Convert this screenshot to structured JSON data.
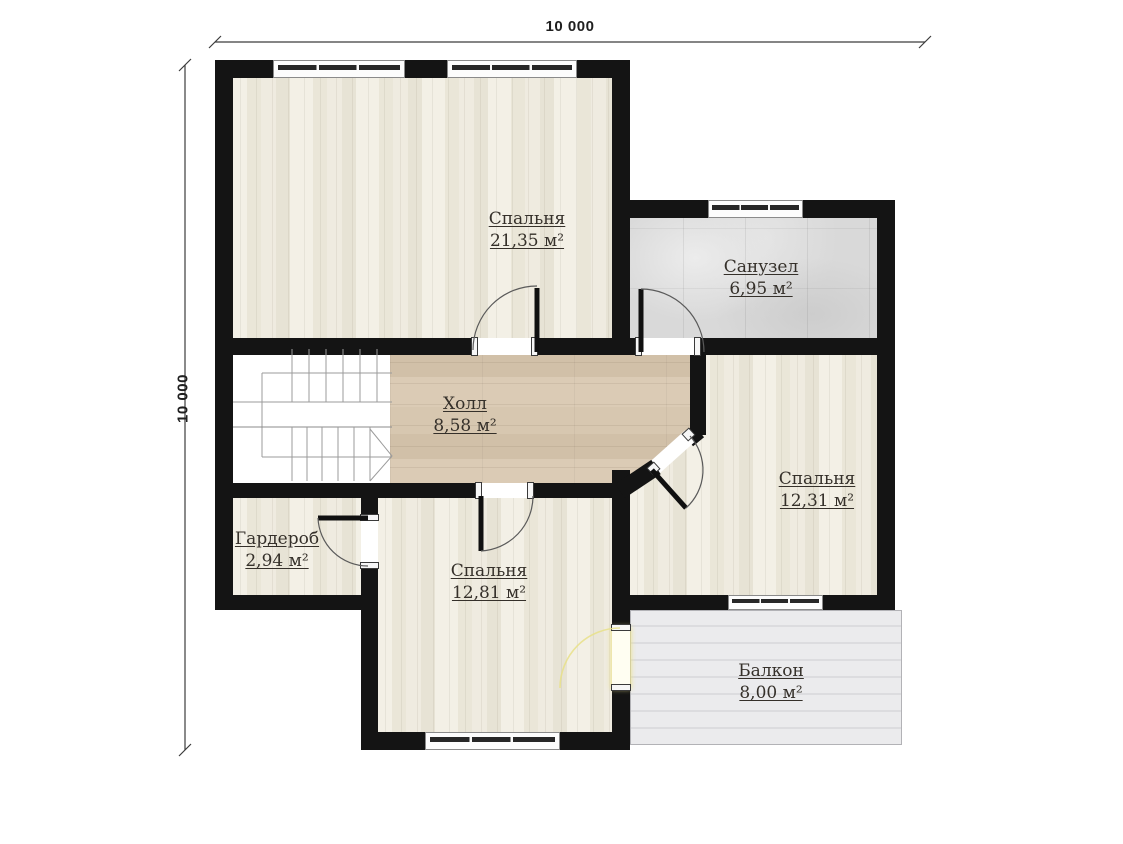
{
  "dimensions": {
    "top": "10 000",
    "left": "10 000"
  },
  "rooms": {
    "bedroom1": {
      "name": "Спальня",
      "area": "21,35 м²"
    },
    "bathroom": {
      "name": "Санузел",
      "area": "6,95 м²"
    },
    "hall": {
      "name": "Холл",
      "area": "8,58 м²"
    },
    "bedroom2": {
      "name": "Спальня",
      "area": "12,31 м²"
    },
    "wardrobe": {
      "name": "Гардероб",
      "area": "2,94 м²"
    },
    "bedroom3": {
      "name": "Спальня",
      "area": "12,81 м²"
    },
    "balcony": {
      "name": "Балкон",
      "area": "8,00 м²"
    }
  },
  "colors": {
    "wall": "#141414",
    "bedroom_floor": "#efece2",
    "hall_floor": "#d6c5ae",
    "bathroom_floor": "#d9d9d9",
    "balcony_floor": "#e7e7ea",
    "balcony_door_highlight": "#ece28a",
    "label_text": "#35302a"
  }
}
